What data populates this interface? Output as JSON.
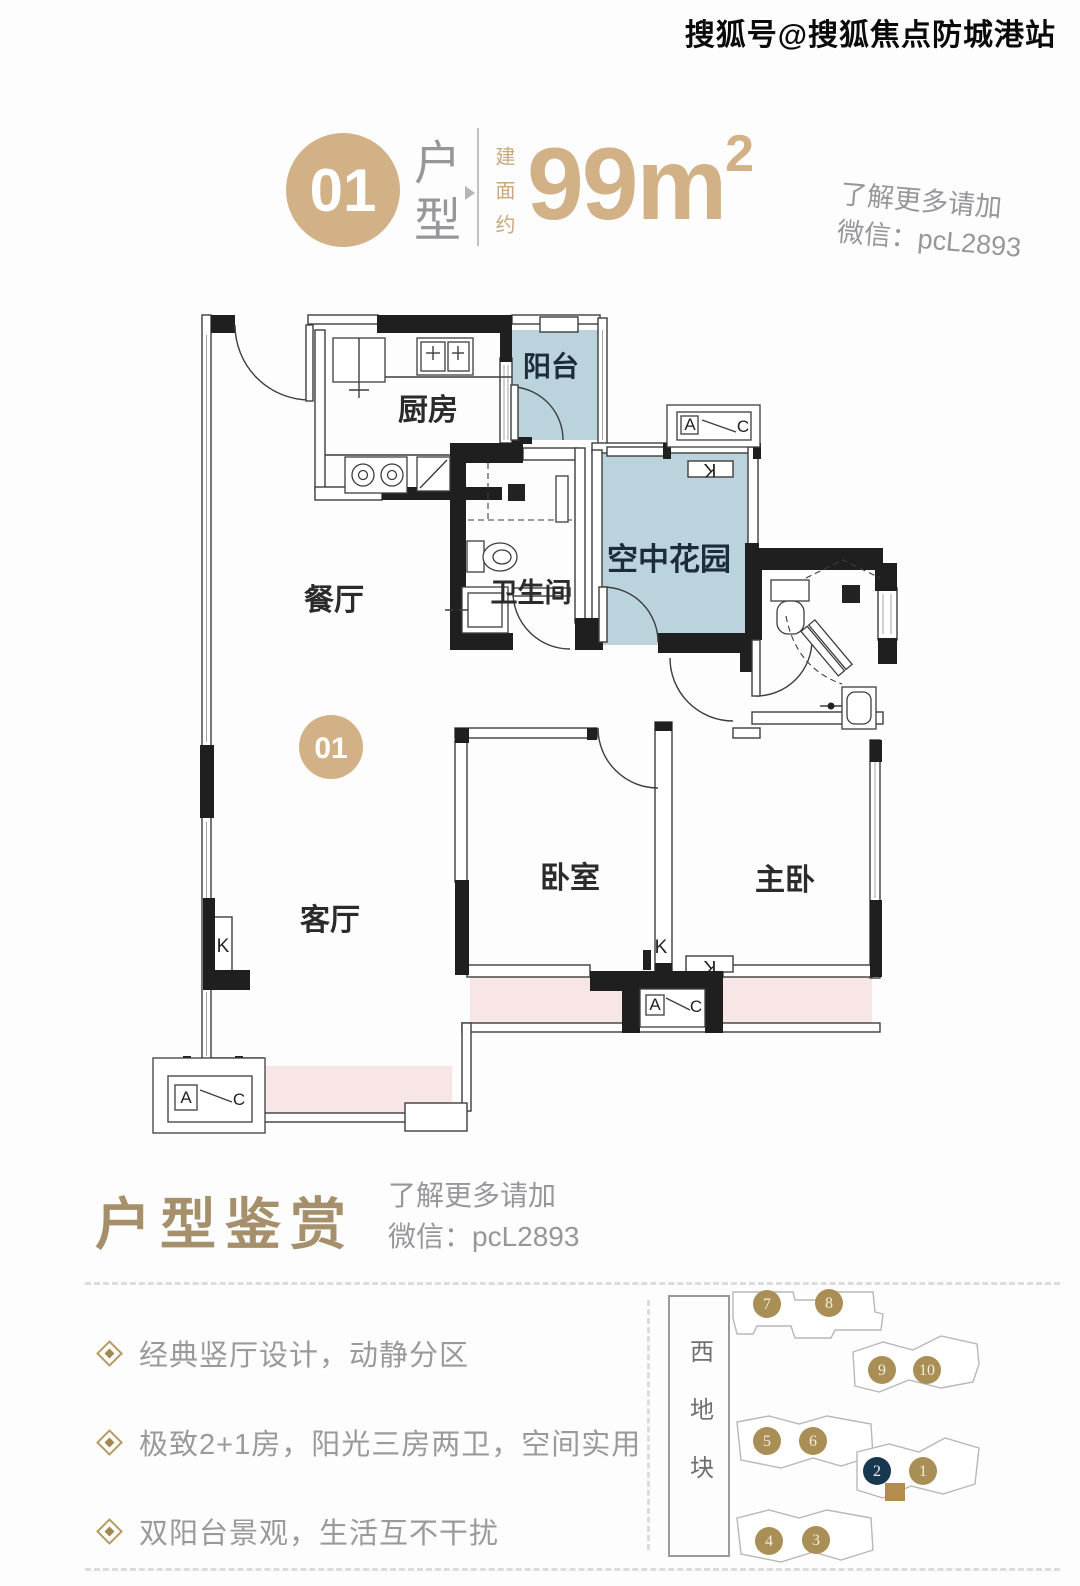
{
  "watermark": "搜狐号@搜狐焦点防城港站",
  "header": {
    "unit_number": "01",
    "unit_type_label": "户型",
    "area_prefix": "建面约",
    "area_value": "99m",
    "area_superscript": "2",
    "contact": {
      "line1": "了解更多请加",
      "line2": "微信：pcL2893"
    }
  },
  "floorplan": {
    "unit_badge": "01",
    "rooms": {
      "kitchen": "厨房",
      "balcony": "阳台",
      "dining": "餐厅",
      "bathroom": "卫生间",
      "sky_garden": "空中花园",
      "living": "客厅",
      "bedroom": "卧室",
      "master_bedroom": "主卧"
    },
    "marks": {
      "duct": "K",
      "ac_a": "A",
      "ac_c": "C"
    }
  },
  "appreciation": {
    "title": "户型鉴赏",
    "contact": {
      "line1": "了解更多请加",
      "line2": "微信：pcL2893"
    },
    "bullets": [
      "经典竖厅设计，动静分区",
      "极致2+1房，阳光三房两卫，空间实用",
      "双阳台景观，生活互不干扰"
    ]
  },
  "sitemap": {
    "district_label": "西地块",
    "buildings": [
      {
        "label": "1"
      },
      {
        "label": "2",
        "highlight": true
      },
      {
        "label": "3"
      },
      {
        "label": "4"
      },
      {
        "label": "5"
      },
      {
        "label": "6"
      },
      {
        "label": "7"
      },
      {
        "label": "8"
      },
      {
        "label": "9"
      },
      {
        "label": "10"
      }
    ]
  },
  "colors": {
    "gold": "#d2b187",
    "gray_text": "#97979a",
    "room_blue": "#bad3dd",
    "balcony_pink": "#f8e6e6",
    "wall_black": "#1f1f1f",
    "serif_gold": "#a5906b",
    "map_gold": "#a98e55",
    "map_navy": "#18384f"
  }
}
